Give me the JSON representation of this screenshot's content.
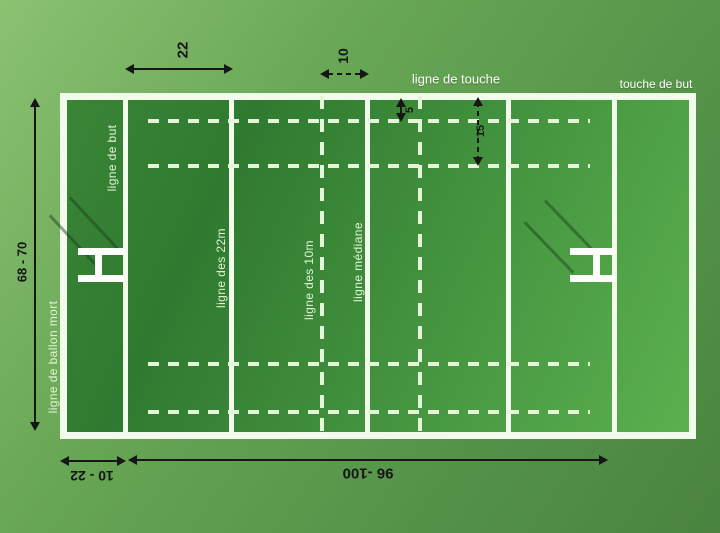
{
  "canvas": {
    "width": 720,
    "height": 533
  },
  "field_labels": {
    "touch_line": "ligne de touche",
    "in_goal_touch_line": "touche de but",
    "goal_line": "ligne de but",
    "line_22m": "ligne des 22m",
    "line_10m": "ligne des 10m",
    "halfway_line": "ligne médiane",
    "dead_ball_line": "ligne de ballon mort"
  },
  "dimension_labels": {
    "zone_22m_width": "22",
    "zone_10m_width": "10",
    "five_metre": "5",
    "fifteen_metre": "15",
    "pitch_width": "68 - 70",
    "in_goal_depth": "10 - 22",
    "pitch_length": "96 -100"
  },
  "colors": {
    "background_green_light": "#8ac272",
    "background_green_dark": "#4a8440",
    "field_green_dark": "#2f7a30",
    "field_green_light": "#5cb04e",
    "line_white": "#f2fbec",
    "dashed_line_white": "#e4f5d8",
    "annotation_black": "#161616",
    "field_label_text": "#e2f4d6",
    "header_label_text": "#ffffff"
  }
}
